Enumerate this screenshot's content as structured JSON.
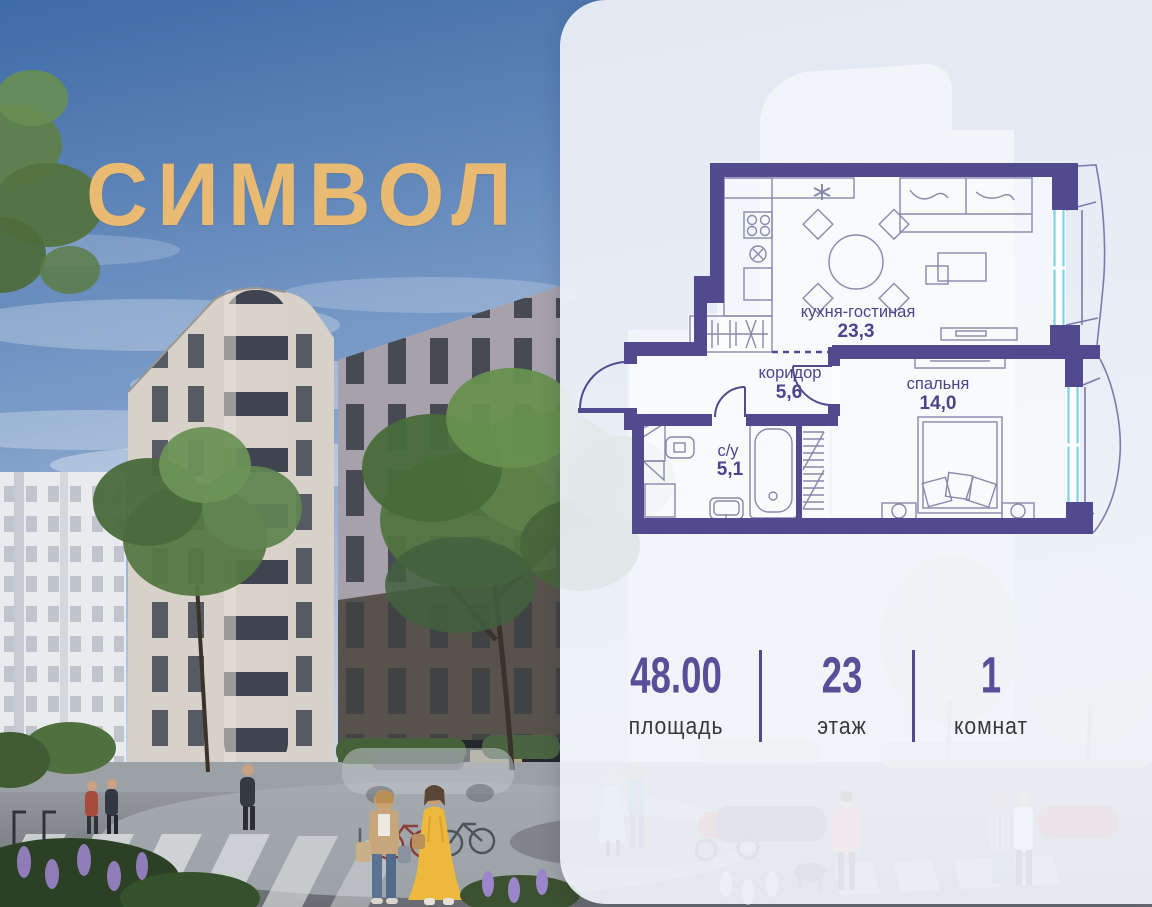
{
  "logo": {
    "text": "СИМВОЛ"
  },
  "plan": {
    "rooms": {
      "kitchen": {
        "name": "кухня-гостиная",
        "area": "23,3"
      },
      "corridor": {
        "name": "коридор",
        "area": "5,6"
      },
      "bedroom": {
        "name": "спальня",
        "area": "14,0"
      },
      "bathroom": {
        "name": "с/у",
        "area": "5,1"
      }
    }
  },
  "stats": {
    "area": {
      "value": "48.00",
      "label": "площадь"
    },
    "floor": {
      "value": "23",
      "label": "этаж"
    },
    "rooms": {
      "value": "1",
      "label": "комнат"
    }
  },
  "colors": {
    "wall": "#514a8e",
    "window": "#7fd2e6",
    "stat_number": "#575099",
    "stat_label": "#38383c",
    "logo_gold": "#e9ba72"
  }
}
